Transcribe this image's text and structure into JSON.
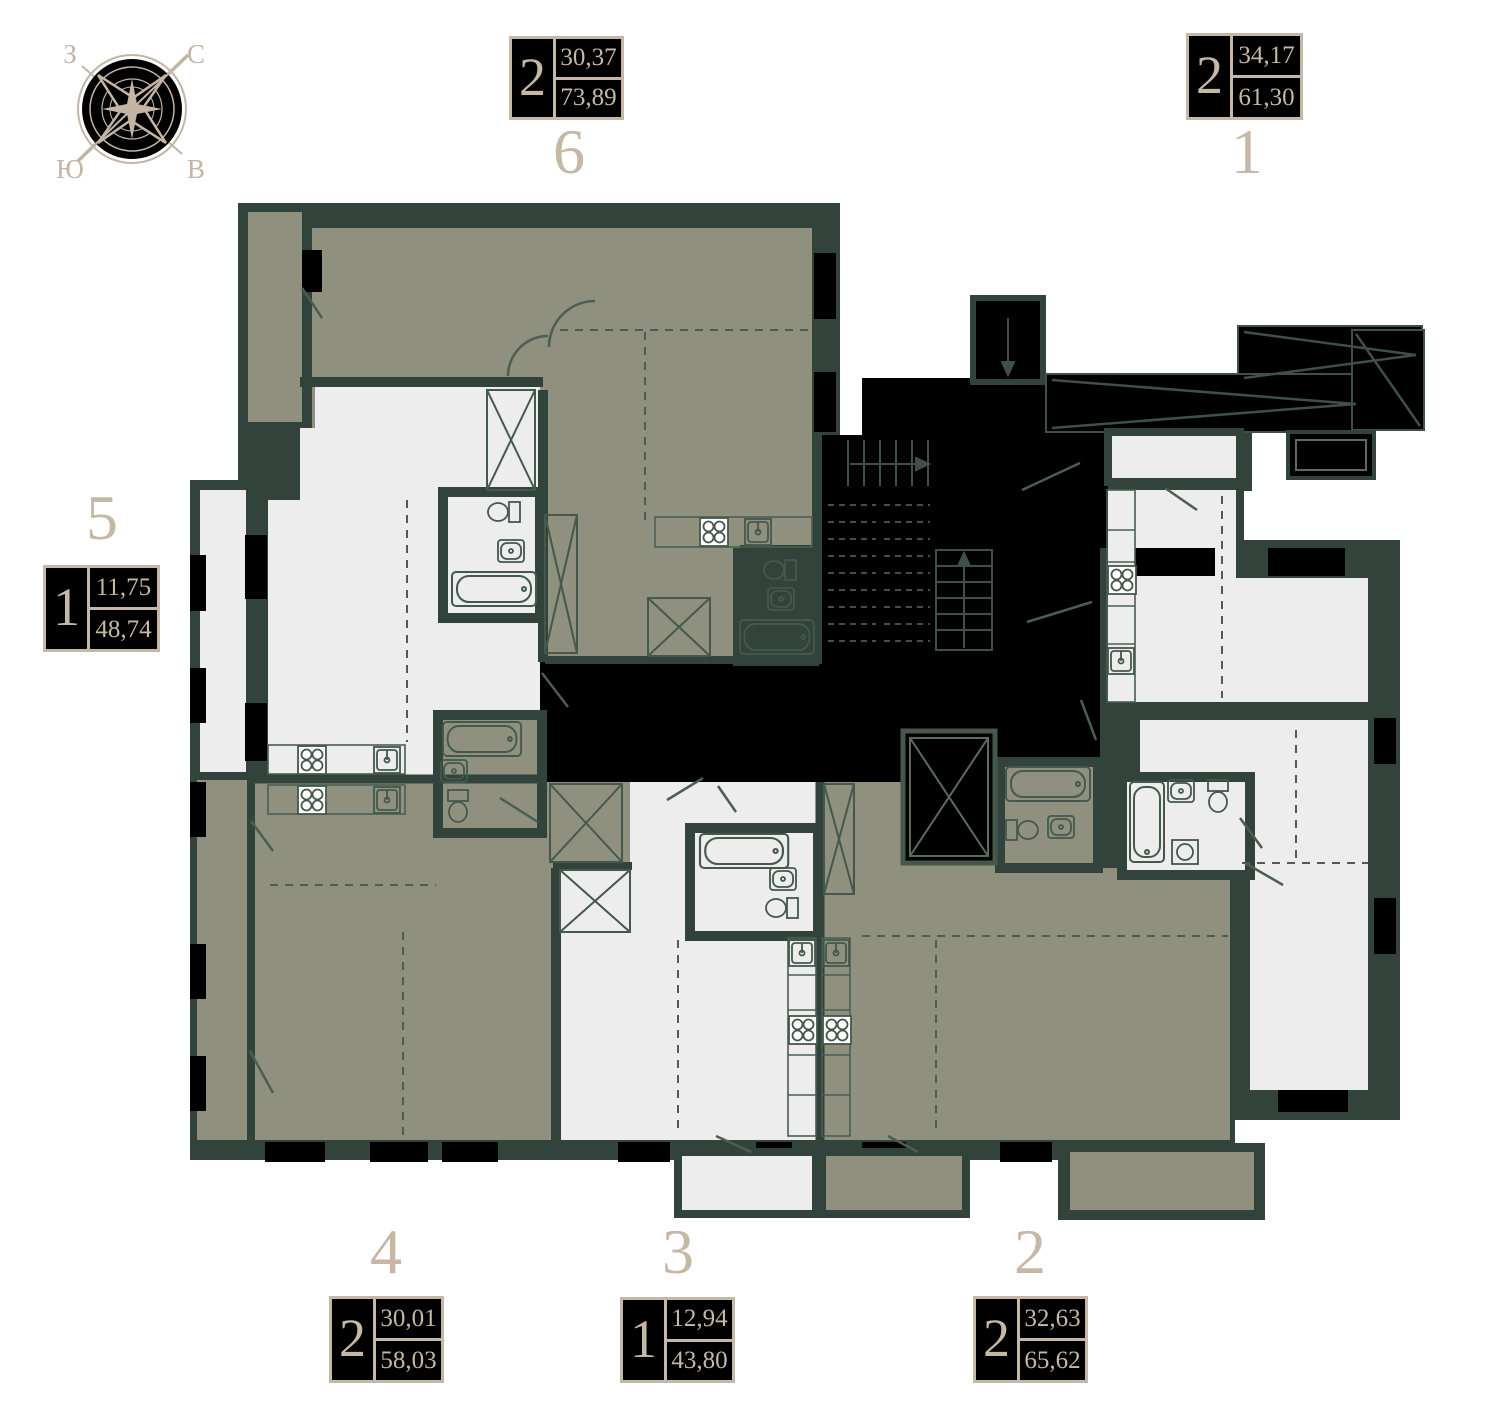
{
  "compass": {
    "west": "З",
    "north": "С",
    "south": "Ю",
    "east": "В"
  },
  "colors": {
    "wall": "#32433B",
    "highlighted_room": "#8F907E",
    "room": "#ECEDEC",
    "core": "#000000",
    "badge_accent": "#C7B8A6",
    "plan_line": "#44584C"
  },
  "units": [
    {
      "number": "1",
      "rooms": "2",
      "area_living": "34,17",
      "area_total": "61,30",
      "highlighted": false,
      "badge_position": "top-right"
    },
    {
      "number": "2",
      "rooms": "2",
      "area_living": "32,63",
      "area_total": "65,62",
      "highlighted": true,
      "badge_position": "bottom-right"
    },
    {
      "number": "3",
      "rooms": "1",
      "area_living": "12,94",
      "area_total": "43,80",
      "highlighted": false,
      "badge_position": "bottom-center"
    },
    {
      "number": "4",
      "rooms": "2",
      "area_living": "30,01",
      "area_total": "58,03",
      "highlighted": true,
      "badge_position": "bottom-left"
    },
    {
      "number": "5",
      "rooms": "1",
      "area_living": "11,75",
      "area_total": "48,74",
      "highlighted": false,
      "badge_position": "middle-left"
    },
    {
      "number": "6",
      "rooms": "2",
      "area_living": "30,37",
      "area_total": "73,89",
      "highlighted": true,
      "badge_position": "top-center"
    }
  ]
}
